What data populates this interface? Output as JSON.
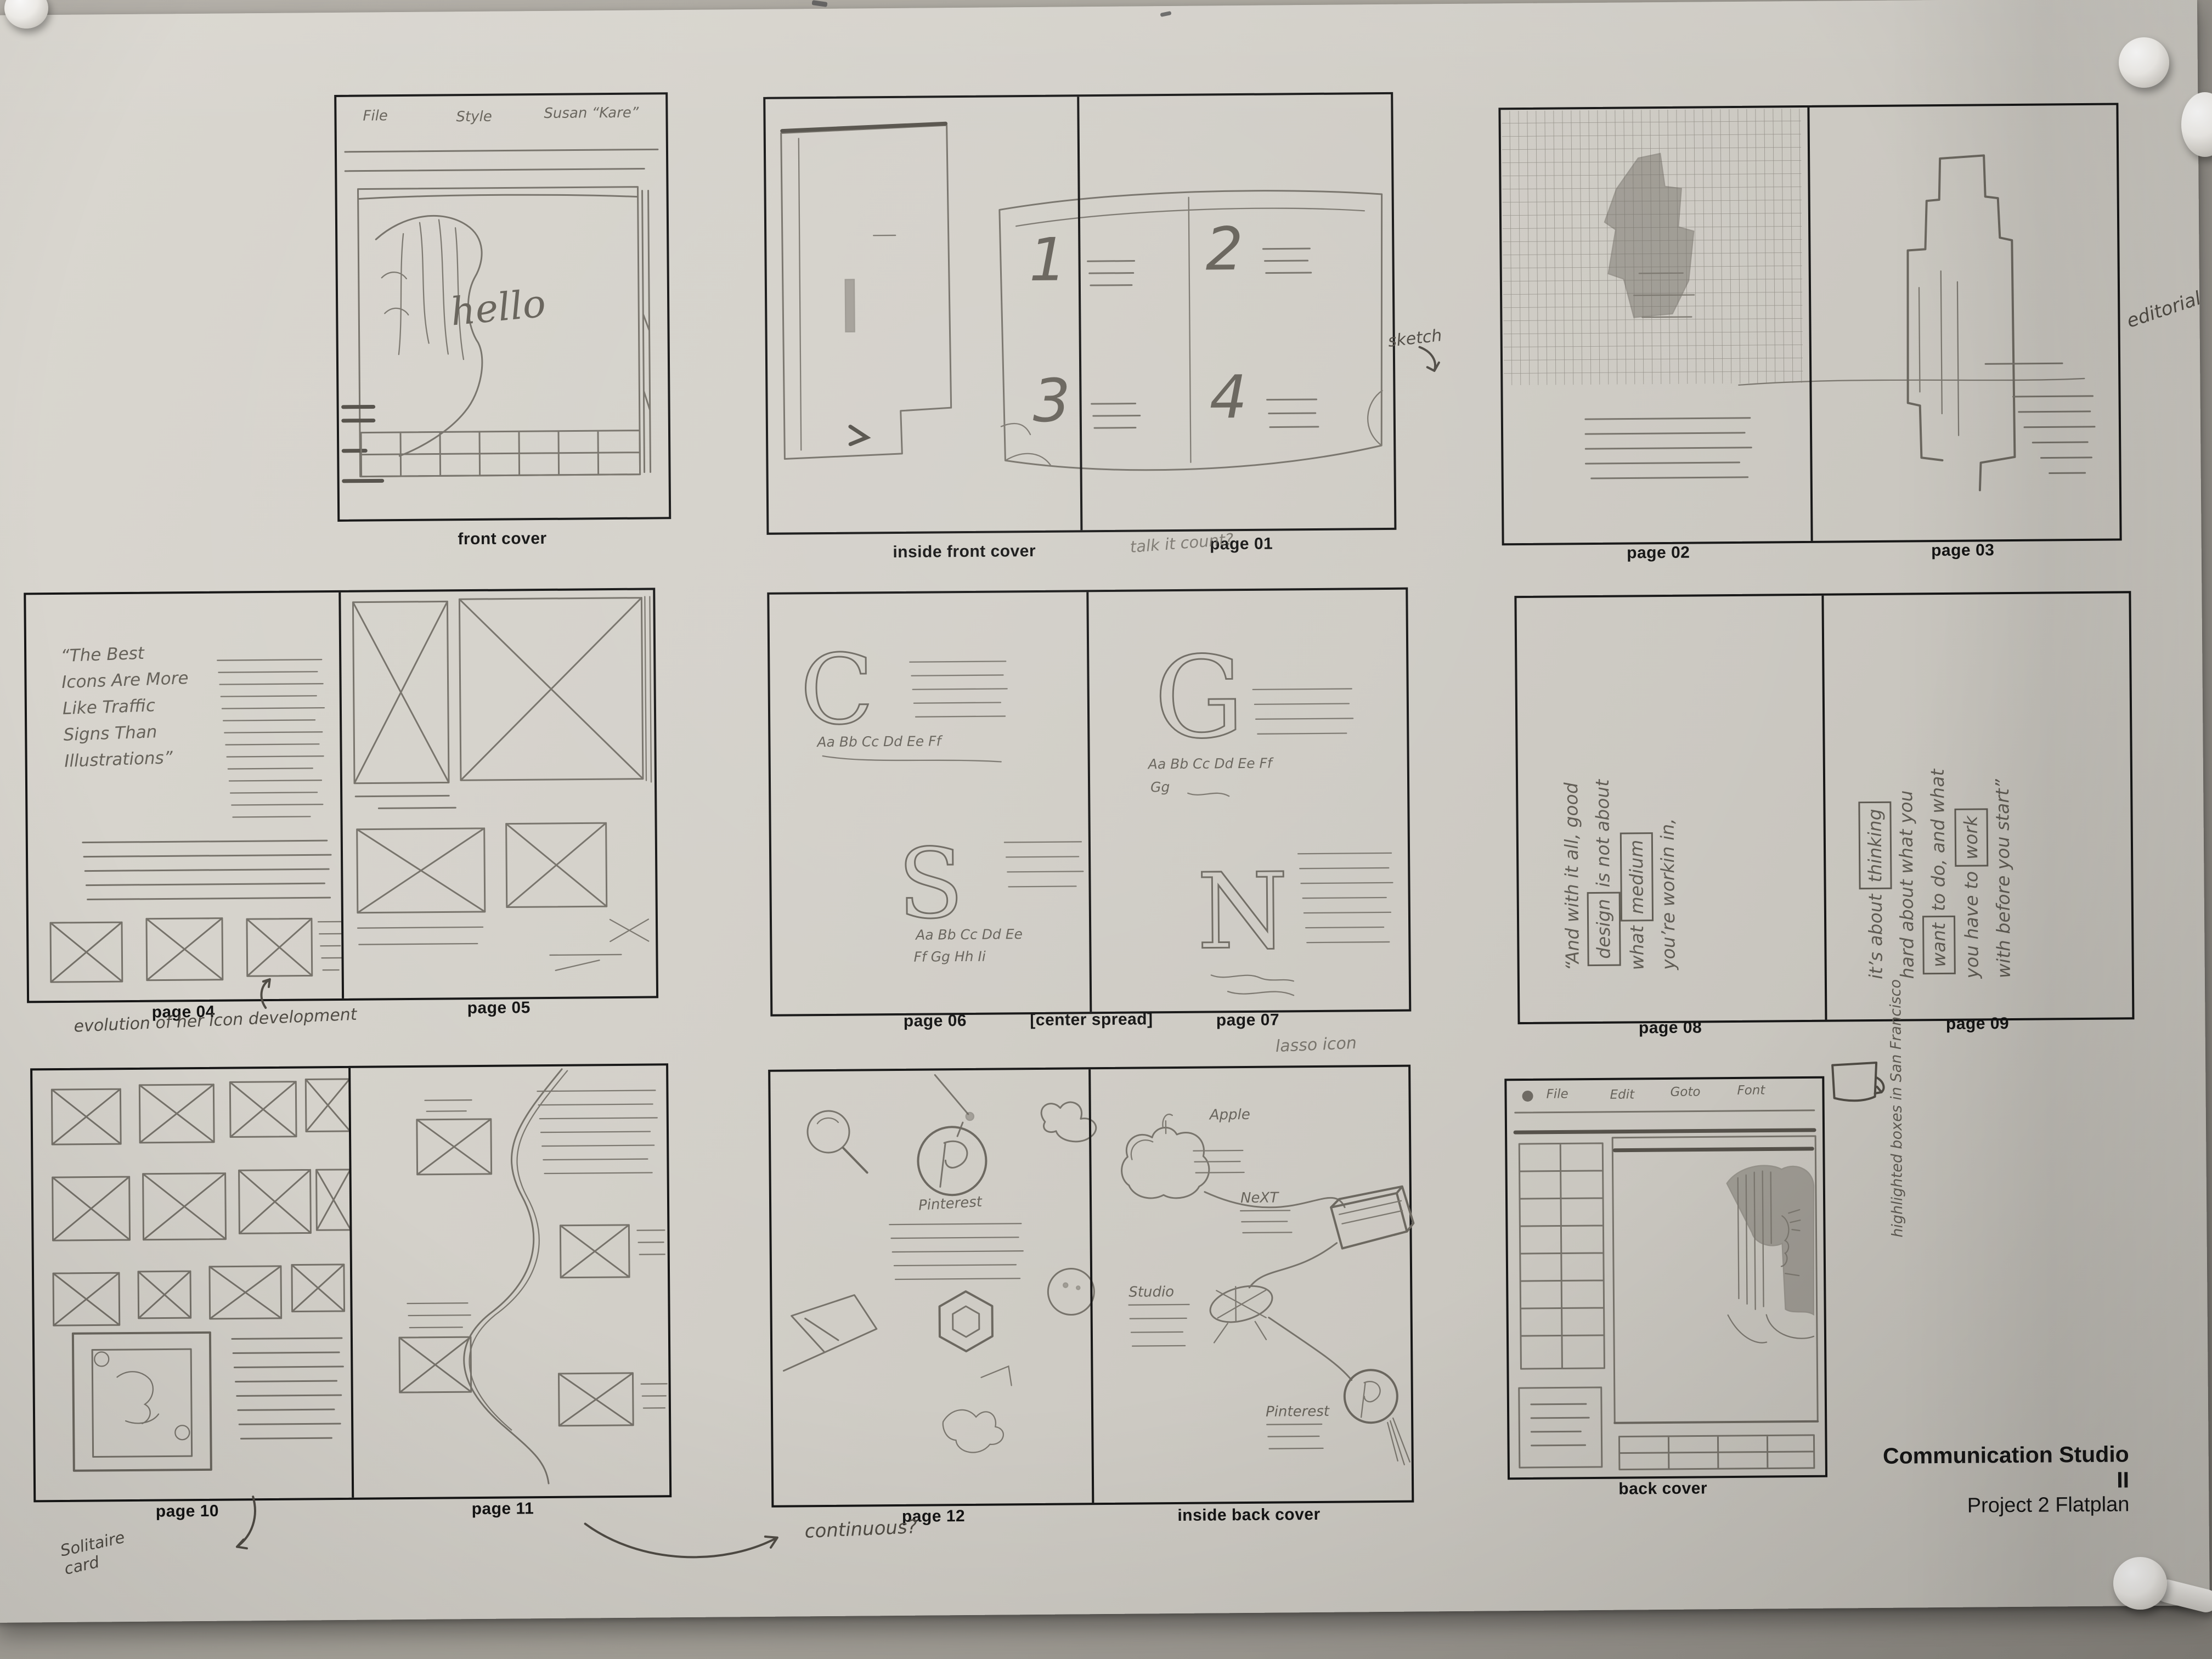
{
  "title_block": {
    "line1": "Communication Studio II",
    "line2": "Project 2 Flatplan"
  },
  "labels": {
    "front_cover": "front cover",
    "inside_front_cover": "inside front cover",
    "page01": "page 01",
    "page02": "page 02",
    "page03": "page 03",
    "page04": "page 04",
    "page05": "page 05",
    "page06": "page 06",
    "center_spread": "[center spread]",
    "page07": "page 07",
    "page08": "page 08",
    "page09": "page 09",
    "page10": "page 10",
    "page11": "page 11",
    "page12": "page 12",
    "inside_back_cover": "inside back cover",
    "back_cover": "back cover"
  },
  "annotations": {
    "sketch_arrow": "sketch",
    "editorial": "editorial",
    "talk_it_count": "talk it count?",
    "evolution": "evolution of her icon development",
    "solitaire_card": "Solitaire card",
    "continuous": "continuous?",
    "lasso_icon": "lasso icon",
    "highlighted_boxes": "highlighted\nboxes in\nSan Francisco"
  },
  "sketch": {
    "front_cover": {
      "menu1": "File",
      "menu2": "Style",
      "menu3": "Susan “Kare”",
      "hello": "hello"
    },
    "toc": {
      "n1": "1",
      "n2": "2",
      "n3": "3",
      "n4": "4"
    },
    "page04": {
      "quote": "“The Best\nIcons Are More\nLike Traffic\nSigns Than\nIllustrations”"
    },
    "page06": {
      "letter_c": "C",
      "alpha_c": "Aa Bb Cc Dd Ee Ff",
      "letter_s": "S",
      "alpha_s1": "Aa Bb Cc Dd Ee",
      "alpha_s2": "Ff Gg Hh Ii"
    },
    "page07": {
      "letter_g": "G",
      "alpha_g": "Aa Bb Cc Dd Ee Ff",
      "alpha_g2": "Gg",
      "letter_n": "N"
    },
    "page08": {
      "l1": "“And with it all, good",
      "w1": "design",
      "l2": "is not about",
      "l3": "what",
      "w2": "medium",
      "l4": "you’re workin in,"
    },
    "page09": {
      "l1": "it’s about",
      "w1": "thinking",
      "l2": "hard about what you",
      "w2": "want",
      "l3": "to do, and what",
      "l4": "you have to",
      "w3": "work",
      "l5": "with before you start”"
    },
    "page12": {
      "pinterest": "Pinterest"
    },
    "inside_back": {
      "apple": "Apple",
      "next": "NeXT",
      "studio": "Studio",
      "pinterest": "Pinterest"
    },
    "back_cover": {
      "menu1": "File",
      "menu2": "Edit",
      "menu3": "Goto",
      "menu4": "Font"
    }
  }
}
